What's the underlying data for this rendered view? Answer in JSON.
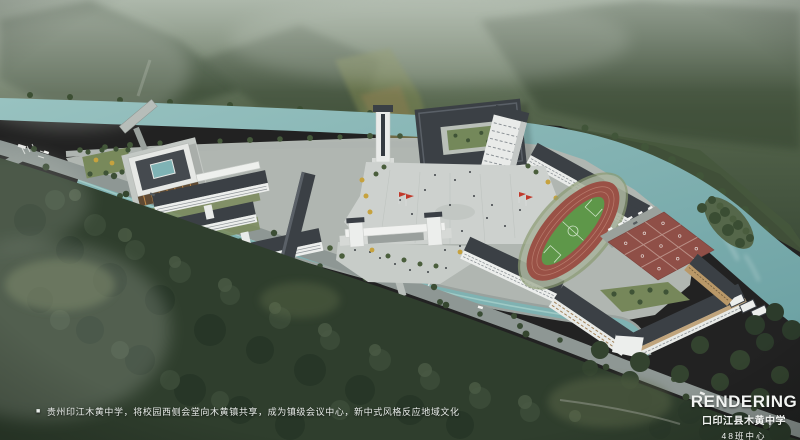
{
  "caption": {
    "bullet": "■",
    "text": "贵州印江木黄中学，将校园西侧会堂向木黄镇共享，成为镇级会议中心，新中式风格反应地域文化"
  },
  "title_block": {
    "label": "RENDERING",
    "project": "口印江县木黄中学",
    "subtitle": "48班中心"
  },
  "scene": {
    "features": [
      {
        "name": "mountains",
        "color": "#42523e"
      },
      {
        "name": "river",
        "color": "#7fb2b2"
      },
      {
        "name": "bridge",
        "color": "#b7bdb9"
      },
      {
        "name": "shared-auditorium",
        "color": "#e6e8e5"
      },
      {
        "name": "west-teaching-cluster",
        "color": "#3b4045"
      },
      {
        "name": "clock-tower",
        "color": "#e9ebe9"
      },
      {
        "name": "north-courtyard-building",
        "color": "#3b4045"
      },
      {
        "name": "dormitory-buildings",
        "color": "#e9ebe9"
      },
      {
        "name": "entrance-gate",
        "color": "#f0f1ef"
      },
      {
        "name": "central-plaza",
        "color": "#cdd1ce"
      },
      {
        "name": "running-track",
        "color": "#9a5146"
      },
      {
        "name": "soccer-field",
        "color": "#5e9749"
      },
      {
        "name": "basketball-courts",
        "color": "#8f4f47"
      },
      {
        "name": "canal",
        "color": "#7fb2b2"
      },
      {
        "name": "roads",
        "color": "#8e9794"
      },
      {
        "name": "forest",
        "color": "#2f3e2d"
      },
      {
        "name": "red-flags",
        "color": "#c0392b"
      },
      {
        "name": "autumn-trees",
        "color": "#c6a23e"
      }
    ]
  }
}
